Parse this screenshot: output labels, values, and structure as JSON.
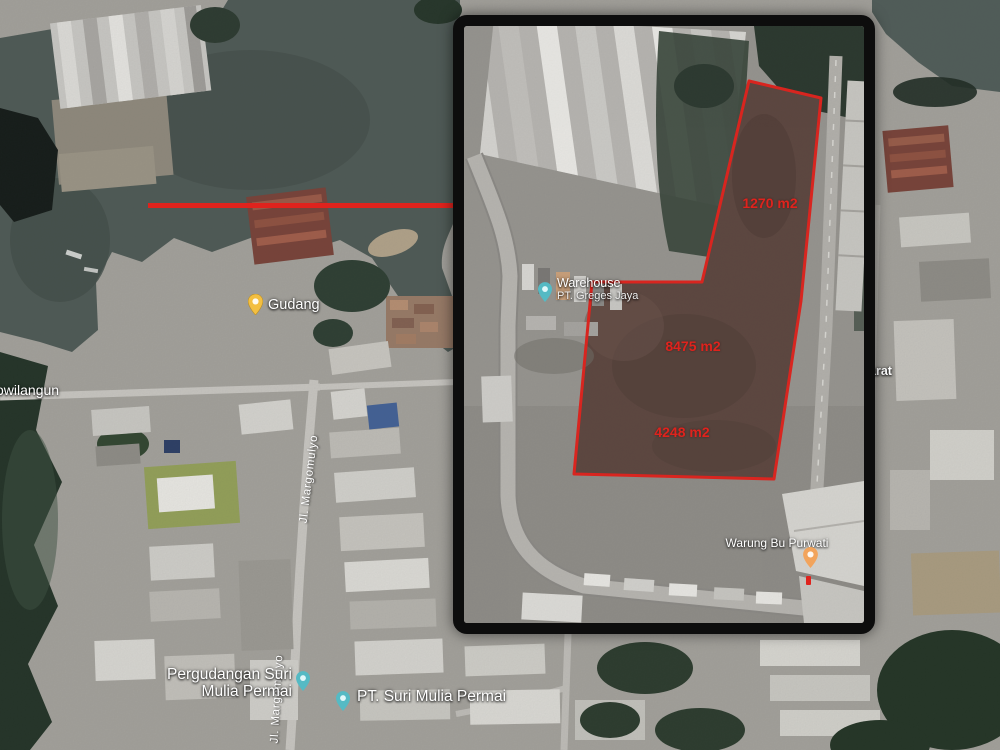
{
  "colors": {
    "annotation-red": "#df231d",
    "inset-border": "#0d0d0d",
    "pin-yellow": "#f3bf41",
    "pin-teal": "#55bac4",
    "pin-orange": "#f2a45c"
  },
  "map": {
    "labels": {
      "gudang": "Gudang",
      "osowilangun": "owilangun",
      "jl_margomulyo": "Jl. Margomulyo",
      "pergudangan_line1": "Pergudangan Suri",
      "pergudangan_line2": "Mulia Permai",
      "pt_suri_mulia": "PT. Suri Mulia Permai",
      "barat_partial": "arat"
    }
  },
  "inset": {
    "area_labels": {
      "top": "1270 m2",
      "middle": "8475 m2",
      "bottom": "4248 m2"
    },
    "poi": {
      "warehouse_line1": "Warehouse",
      "warehouse_line2": "PT. Greges Jaya",
      "warung": "Warung Bu Purwati"
    }
  }
}
